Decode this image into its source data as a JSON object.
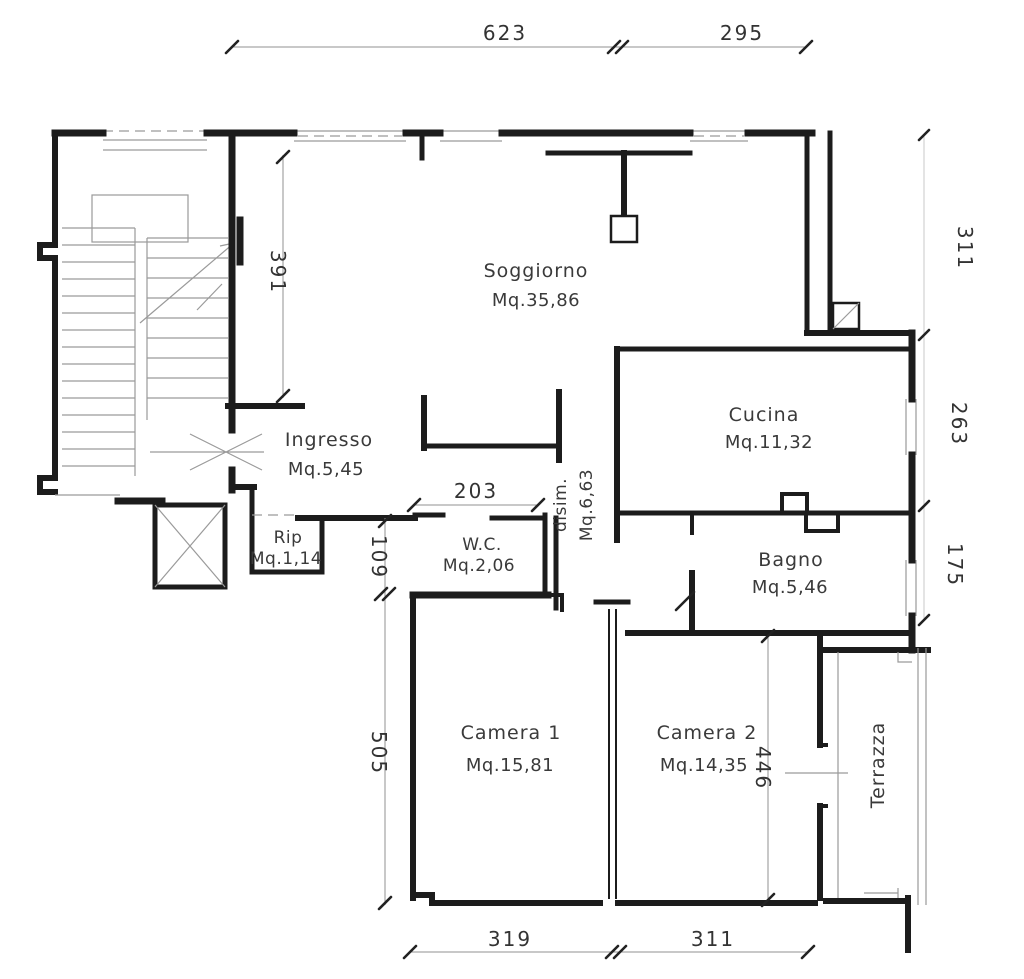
{
  "plan": {
    "rooms": {
      "soggiorno": {
        "name": "Soggiorno",
        "area": "Mq.35,86"
      },
      "cucina": {
        "name": "Cucina",
        "area": "Mq.11,32"
      },
      "ingresso": {
        "name": "Ingresso",
        "area": "Mq.5,45"
      },
      "rip": {
        "name": "Rip",
        "area": "Mq.1,14"
      },
      "wc": {
        "name": "W.C.",
        "area": "Mq.2,06"
      },
      "disimpegno": {
        "name": "disim.",
        "area": "Mq.6,63"
      },
      "bagno": {
        "name": "Bagno",
        "area": "Mq.5,46"
      },
      "camera1": {
        "name": "Camera 1",
        "area": "Mq.15,81"
      },
      "camera2": {
        "name": "Camera 2",
        "area": "Mq.14,35"
      },
      "terrazza": {
        "name": "Terrazza"
      }
    },
    "dimensions": {
      "top_623": "623",
      "top_295": "295",
      "right_311": "311",
      "right_263": "263",
      "right_175": "175",
      "left_391": "391",
      "left_109": "109",
      "left_505": "505",
      "wc_203": "203",
      "camera2_446": "446",
      "bottom_319": "319",
      "bottom_311": "311"
    },
    "colors": {
      "wall": "#1c1c1c",
      "thin_line": "#9a9a9a",
      "dimension_text": "#333333",
      "room_text": "#3a3a3a",
      "background": "#ffffff"
    }
  }
}
